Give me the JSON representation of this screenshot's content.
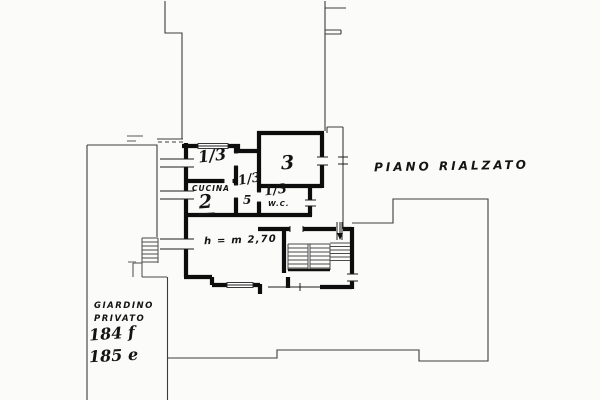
{
  "drawing": {
    "title": "PIANO RIALZATO",
    "paper_color": "#fbfbf9",
    "ink_color": "#0d0d0d",
    "rooms": {
      "room_top_left_fraction": "1/3",
      "kitchen_label": "CUCINA",
      "kitchen_number": "2",
      "room3_number": "3",
      "corridor_fraction": "1/3",
      "corridor_number": "5",
      "wc_fraction": "1/3",
      "wc_label": "W.C.",
      "height_note": "h = m 2,70"
    },
    "garden": {
      "label_line1": "GIARDINO",
      "label_line2": "PRIVATO",
      "parcel_1": "184 f",
      "parcel_2": "185 e"
    }
  }
}
